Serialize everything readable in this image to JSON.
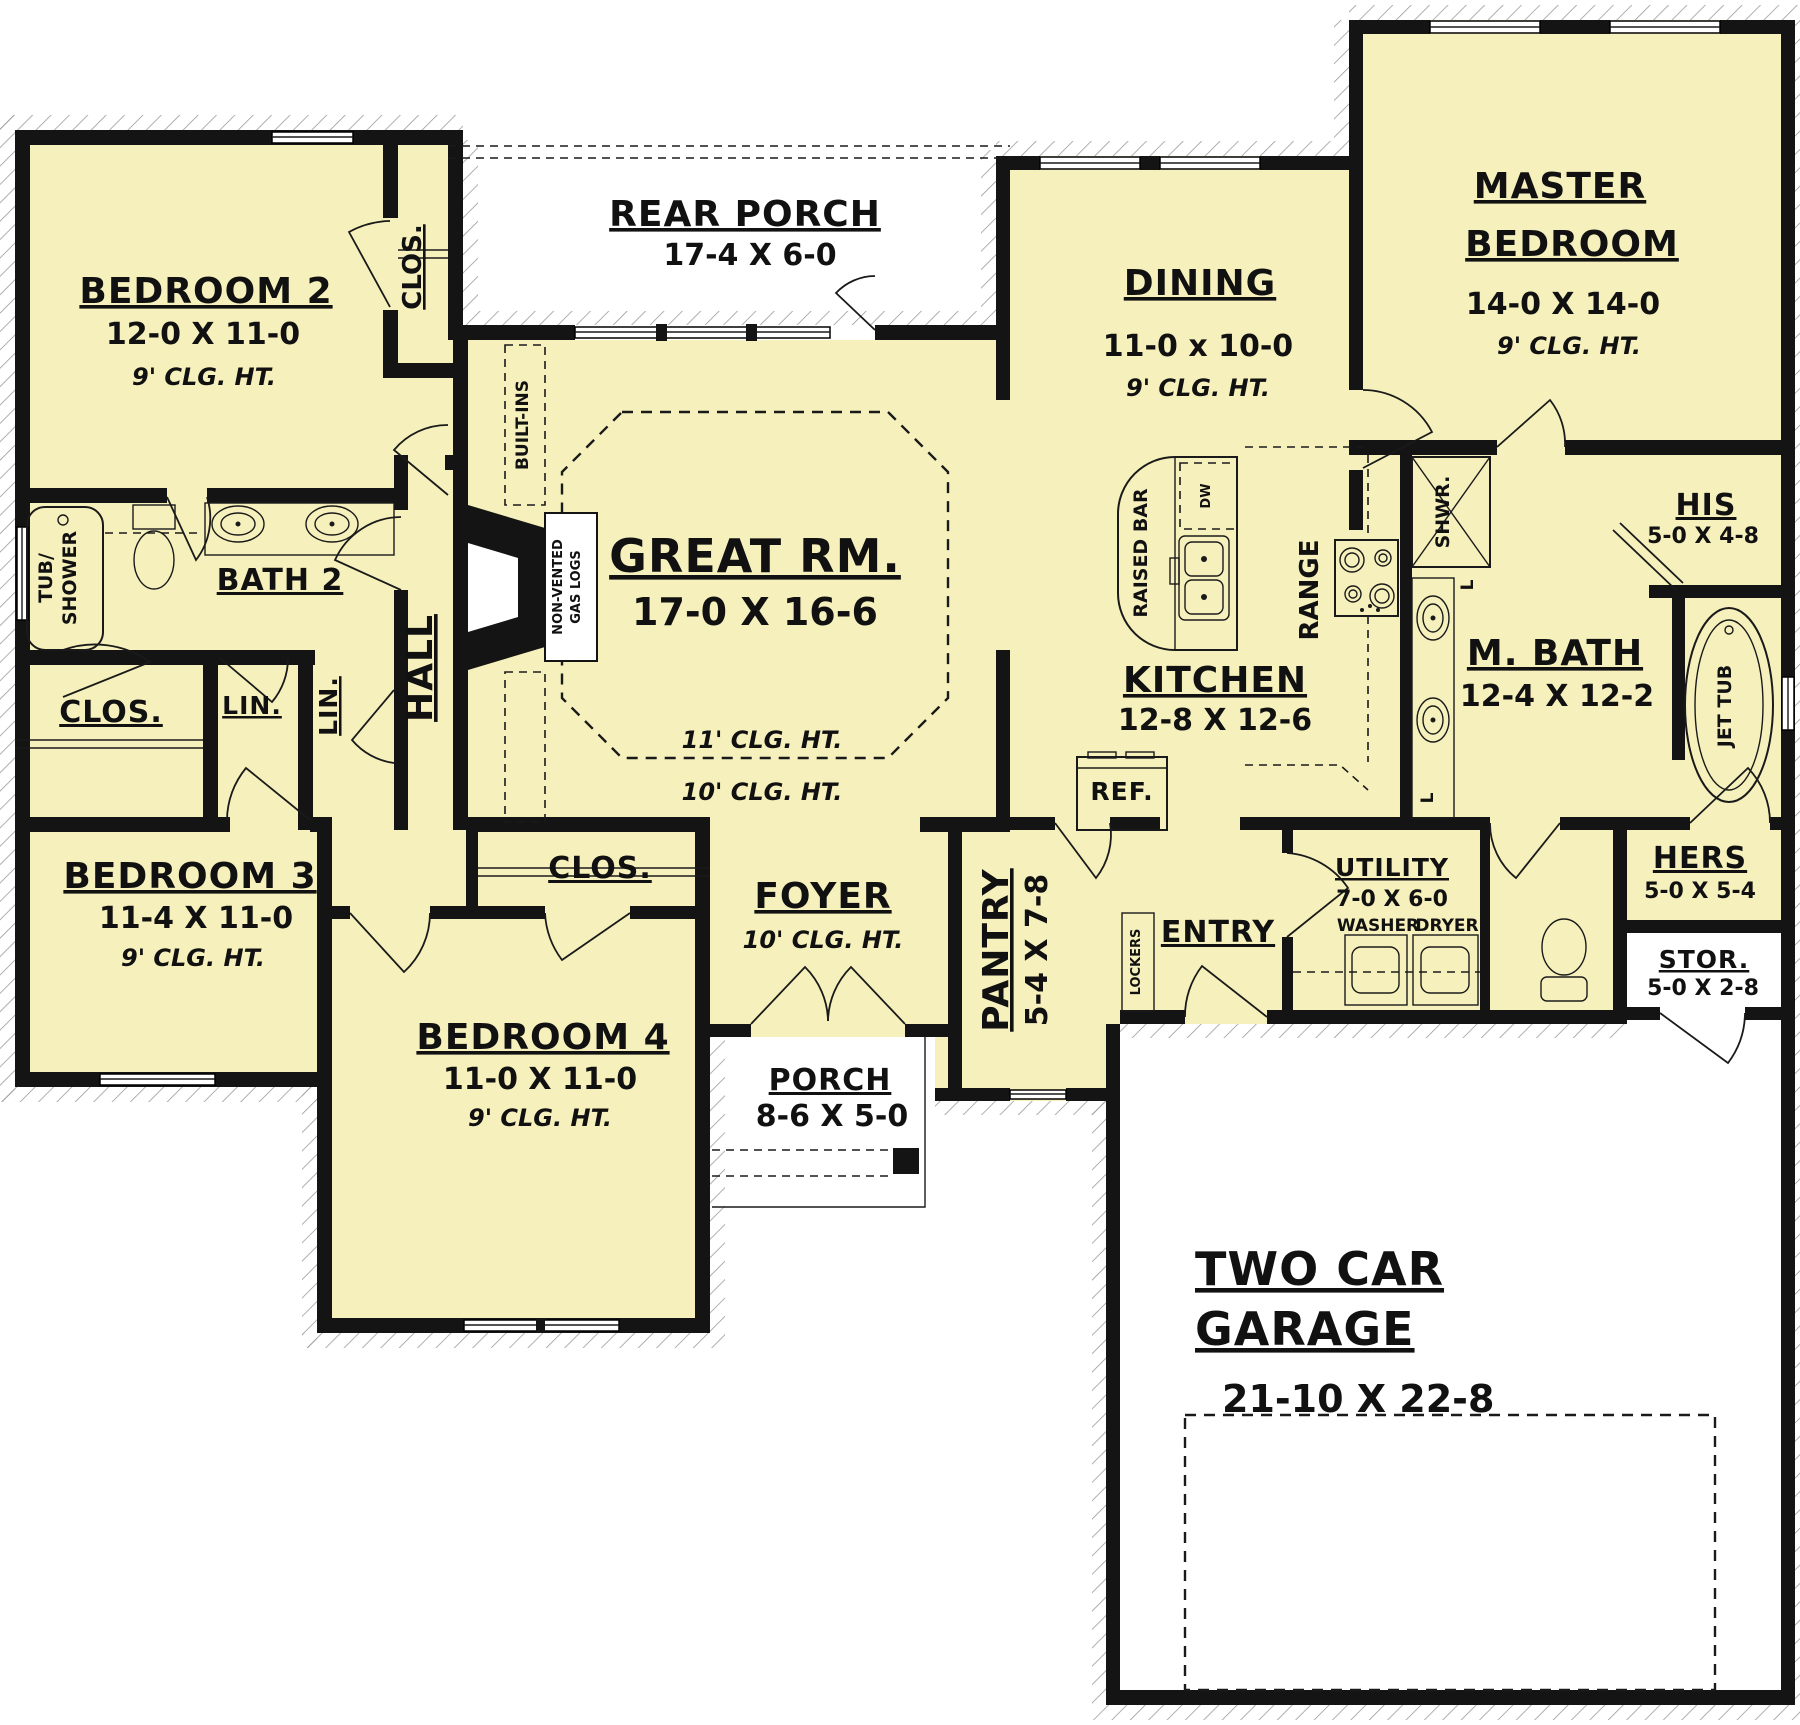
{
  "colors": {
    "room_fill": "#F6F1BC",
    "wall": "#141414",
    "hatch_line": "#9B9B9B"
  },
  "rooms": {
    "bedroom2": {
      "name": "BEDROOM 2",
      "dims": "12-0 X 11-0",
      "clg": "9' CLG. HT."
    },
    "bedroom2_closet": {
      "name": "CLOS."
    },
    "rear_porch": {
      "name": "REAR PORCH",
      "dims": "17-4 X 6-0"
    },
    "dining": {
      "name": "DINING",
      "dims": "11-0 x 10-0",
      "clg": "9' CLG. HT."
    },
    "master": {
      "name_line1": "MASTER",
      "name_line2": "BEDROOM",
      "dims": "14-0 X 14-0",
      "clg": "9' CLG. HT."
    },
    "bath2": {
      "name": "BATH 2"
    },
    "hall": {
      "name": "HALL"
    },
    "closet1": {
      "name": "CLOS."
    },
    "linen1": {
      "name": "LIN."
    },
    "linen2": {
      "name": "LIN."
    },
    "great_room": {
      "name": "GREAT RM.",
      "dims": "17-0 X 16-6",
      "clg_upper": "11' CLG. HT.",
      "clg_lower": "10' CLG. HT."
    },
    "kitchen": {
      "name": "KITCHEN",
      "dims": "12-8 X 12-6"
    },
    "bedroom3": {
      "name": "BEDROOM 3",
      "dims": "11-4 X 11-0",
      "clg": "9' CLG. HT."
    },
    "bedroom4": {
      "name": "BEDROOM 4",
      "dims": "11-0 X 11-0",
      "clg": "9' CLG. HT."
    },
    "bedroom4_closet": {
      "name": "CLOS."
    },
    "foyer": {
      "name": "FOYER",
      "clg": "10' CLG. HT."
    },
    "porch": {
      "name": "PORCH",
      "dims": "8-6 X 5-0"
    },
    "pantry": {
      "name": "PANTRY",
      "dims": "5-4 X 7-8"
    },
    "entry": {
      "name": "ENTRY"
    },
    "utility": {
      "name": "UTILITY",
      "dims": "7-0 X 6-0"
    },
    "master_bath": {
      "name": "M. BATH",
      "dims": "12-4 X 12-2"
    },
    "his_closet": {
      "name": "HIS",
      "dims": "5-0 X 4-8"
    },
    "hers_closet": {
      "name": "HERS",
      "dims": "5-0 X 5-4"
    },
    "storage": {
      "name": "STOR.",
      "dims": "5-0 X 2-8"
    },
    "garage": {
      "name_line1": "TWO CAR",
      "name_line2": "GARAGE",
      "dims": "21-10 X 22-8"
    }
  },
  "fixtures": {
    "tub_shower_line1": "TUB/",
    "tub_shower_line2": "SHOWER",
    "built_ins": "BUILT-INS",
    "gas_logs_line1": "NON-VENTED",
    "gas_logs_line2": "GAS LOGS",
    "raised_bar": "RAISED BAR",
    "dishwasher": "DW",
    "range": "RANGE",
    "refrigerator": "REF.",
    "shower": "SHWR.",
    "jet_tub": "JET TUB",
    "washer": "WASHER",
    "dryer": "DRYER",
    "lockers": "LOCKERS",
    "linen_cabinet1": "L",
    "linen_cabinet2": "L"
  }
}
